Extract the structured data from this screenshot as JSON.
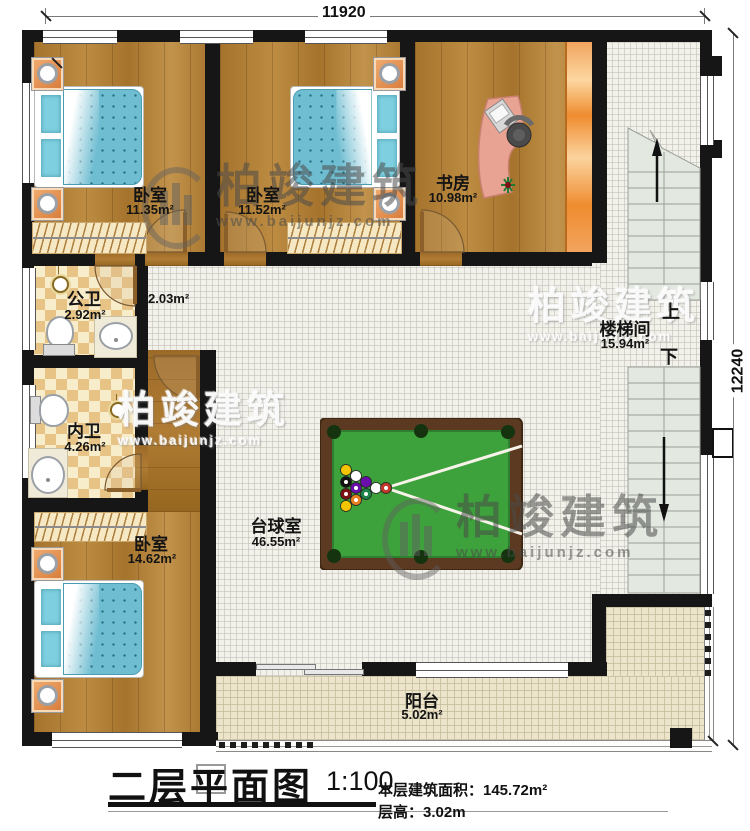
{
  "dimensions": {
    "top": "11920",
    "right": "12240"
  },
  "watermark": {
    "brand": "柏竣建筑",
    "url": "www.baijunjz.com"
  },
  "rooms": {
    "bedroom_top_left": {
      "label": "卧室",
      "area": "11.35m²"
    },
    "bedroom_top_mid": {
      "label": "卧室",
      "area": "11.52m²"
    },
    "study": {
      "label": "书房",
      "area": "10.98m²"
    },
    "hallway": {
      "area": "2.03m²"
    },
    "public_bath": {
      "label": "公卫",
      "area": "2.92m²"
    },
    "ensuite_bath": {
      "label": "内卫",
      "area": "4.26m²"
    },
    "bedroom_bottom_left": {
      "label": "卧室",
      "area": "14.62m²"
    },
    "billiard_room": {
      "label": "台球室",
      "area": "46.55m²"
    },
    "stairwell": {
      "label": "楼梯间",
      "area": "15.94m²",
      "up_label": "上",
      "down_label": "下"
    },
    "balcony": {
      "label": "阳台",
      "area": "5.02m²"
    }
  },
  "title_block": {
    "title": "二层平面图",
    "scale": "1:100",
    "floor_area_line": "本层建筑面积：145.72m²",
    "floor_height_line": "层高：3.02m"
  },
  "colors": {
    "wall": "#161616",
    "wood_floor": "#b08036",
    "tile_floor": "#f2f1ea",
    "balcony_floor": "#ece4cb",
    "bathroom_tile": "#e7c386",
    "billiard_felt": "#3da23b",
    "billiard_frame": "#5b3a21",
    "bed_blue": "#6fbdd1",
    "accent_orange": "#ef8c2f",
    "stair_tread": "#e3e8e0"
  }
}
